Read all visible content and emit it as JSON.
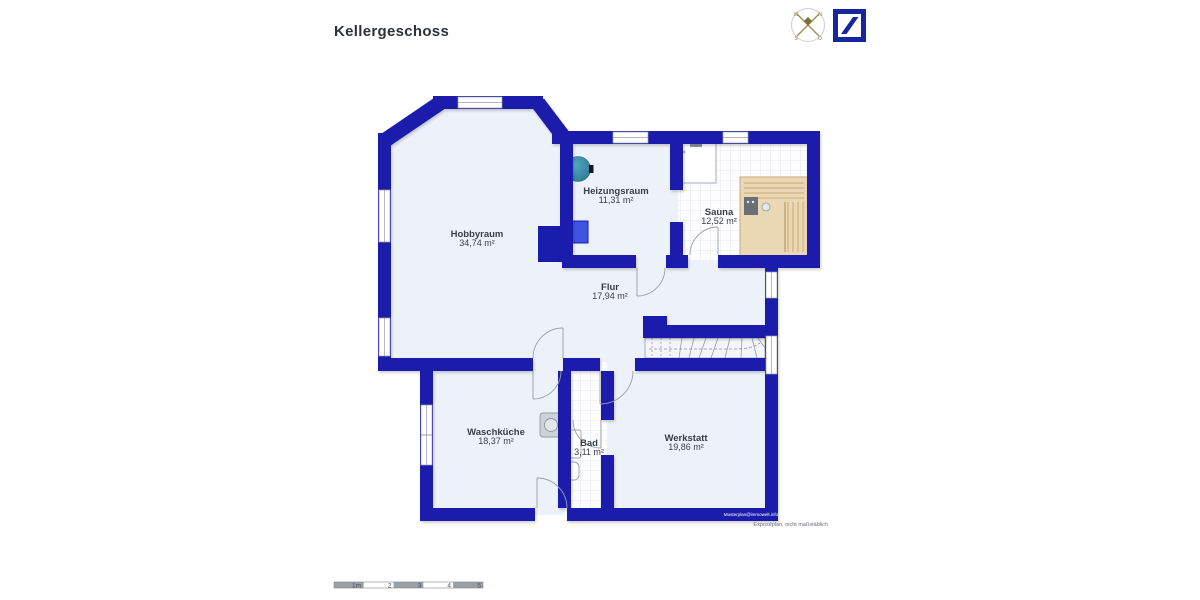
{
  "header": {
    "title": "Kellergeschoss"
  },
  "compass": {
    "n": "N",
    "e": "O",
    "s": "S",
    "w": "W"
  },
  "rooms": [
    {
      "name": "Hobbyraum",
      "area": "34,74 m²"
    },
    {
      "name": "Heizungsraum",
      "area": "11,31 m²"
    },
    {
      "name": "Sauna",
      "area": "12,52 m²"
    },
    {
      "name": "Flur",
      "area": "17,94 m²"
    },
    {
      "name": "Waschküche",
      "area": "18,37 m²"
    },
    {
      "name": "Bad",
      "area": "3,11 m²"
    },
    {
      "name": "Werkstatt",
      "area": "19,86 m²"
    }
  ],
  "footnotes": {
    "watermark": "Musterplan@immowelt.info",
    "disclaimer": "Exposéplan, nicht maßstäblich"
  },
  "scalebar": {
    "labels": [
      "1m",
      "2",
      "3",
      "4",
      "5"
    ]
  },
  "colors": {
    "wall": "#1a1dac",
    "room_fill": "#edf1fa",
    "tank_teal": "#3a8ca6",
    "wood": "#ead7b4"
  }
}
